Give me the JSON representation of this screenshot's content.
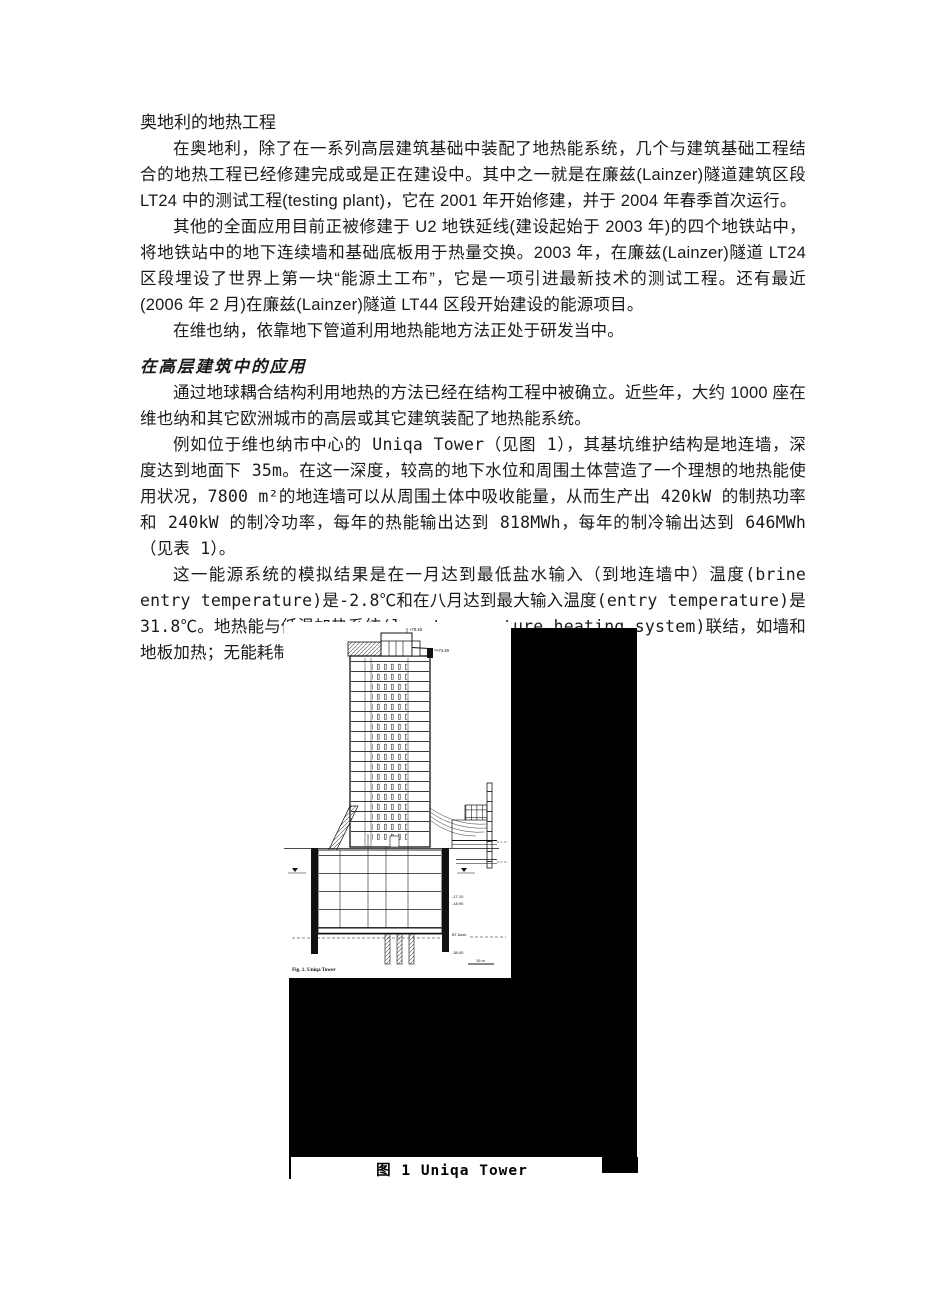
{
  "document": {
    "title": "奥地利的地热工程",
    "intro_paragraphs": [
      "在奥地利，除了在一系列高层建筑基础中装配了地热能系统，几个与建筑基础工程结合的地热工程已经修建完成或是正在建设中。其中之一就是在廉兹(Lainzer)隧道建筑区段 LT24 中的测试工程(testing plant)，它在 2001 年开始修建，并于 2004 年春季首次运行。",
      "其他的全面应用目前正被修建于 U2 地铁延线(建设起始于 2003 年)的四个地铁站中，将地铁站中的地下连续墙和基础底板用于热量交换。2003 年，在廉兹(Lainzer)隧道 LT24 区段埋设了世界上第一块“能源土工布”，它是一项引进最新技术的测试工程。还有最近(2006 年 2 月)在廉兹(Lainzer)隧道 LT44 区段开始建设的能源项目。",
      "在维也纳，依靠地下管道利用地热能地方法正处于研发当中。"
    ],
    "section": {
      "heading": "在高层建筑中的应用",
      "paragraphs": [
        "通过地球耦合结构利用地热的方法已经在结构工程中被确立。近些年，大约 1000 座在维也纳和其它欧洲城市的高层或其它建筑装配了地热能系统。",
        "例如位于维也纳市中心的 Uniqa Tower（见图 1），其基坑维护结构是地连墙，深度达到地面下 35m。在这一深度，较高的地下水位和周围土体营造了一个理想的地热能使用状况，7800 m²的地连墙可以从周围土体中吸收能量，从而生产出 420kW 的制热功率和 240kW 的制冷功率，每年的热能输出达到 818MWh，每年的制冷输出达到 646MWh（见表 1）。",
        "这一能源系统的模拟结果是在一月达到最低盐水输入（到地连墙中）温度(brine entry temperature)是-2.8℃和在八月达到最大输入温度(entry temperature)是 31.8℃。地热能与低温加热系统(low-temperature heating system)联结，如墙和地板加热；无能耗制冷用于支持传统的制冷系统。"
      ]
    },
    "figure": {
      "caption": "图 1 Uniqa Tower",
      "drawing_label": "Fig. 1. Uniqa Tower",
      "annotations": {
        "top_elevation": "+79.48",
        "roof_elevation": "+74.48",
        "ground_elevation": "±0.00",
        "basement_elevation_1": "-17.10",
        "basement_elevation_2": "-18.90",
        "excavation_label": "BT Aush.",
        "wall_base_elevation": "-38.00",
        "scale": "15 m"
      }
    }
  }
}
